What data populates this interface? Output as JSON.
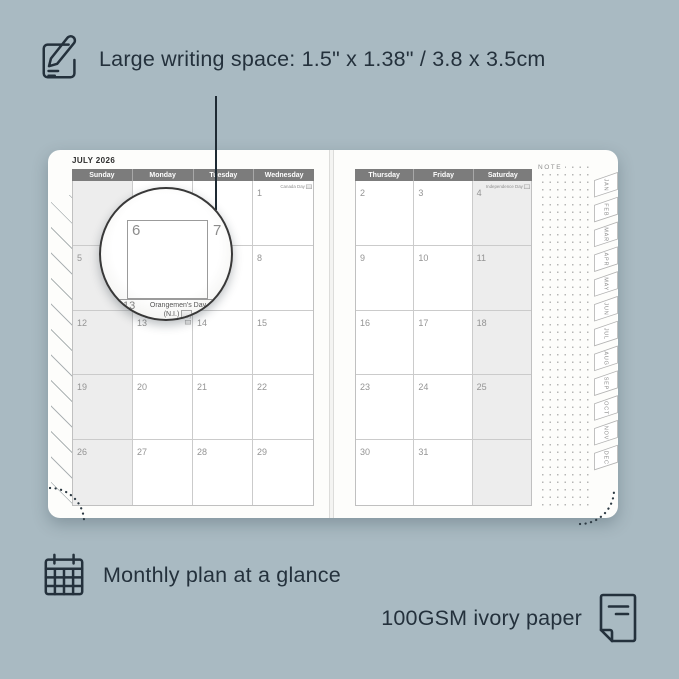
{
  "colors": {
    "background": "#a9bac2",
    "annotation_text": "#24313c",
    "page": "#fdfdfb",
    "header_gray": "#7c7c7c",
    "shaded_column": "#ededed",
    "grid_line": "#cbcbcb",
    "date_text": "#949494"
  },
  "annotations": {
    "top": {
      "icon": "pencil-note-icon",
      "text": "Large writing space: 1.5\" x 1.38\" / 3.8 x 3.5cm"
    },
    "bottom_left": {
      "icon": "calendar-grid-icon",
      "text": "Monthly plan at a glance"
    },
    "bottom_right": {
      "icon": "paper-sheet-icon",
      "text": "100GSM ivory paper"
    }
  },
  "planner": {
    "month_title": "JULY 2026",
    "note_label": "NOTE",
    "left_page": {
      "day_headers": [
        "Sunday",
        "Monday",
        "Tuesday",
        "Wednesday"
      ],
      "shaded_column_index": 0,
      "rows": [
        [
          {
            "date": ""
          },
          {
            "date": ""
          },
          {
            "date": ""
          },
          {
            "date": "1",
            "holiday": "Canada Day",
            "flag": true
          }
        ],
        [
          {
            "date": "5"
          },
          {
            "date": "6"
          },
          {
            "date": "7"
          },
          {
            "date": "8"
          }
        ],
        [
          {
            "date": "12"
          },
          {
            "date": "13",
            "holiday": "Orangemen's Day (N.I.)",
            "flag": true
          },
          {
            "date": "14"
          },
          {
            "date": "15"
          }
        ],
        [
          {
            "date": "19"
          },
          {
            "date": "20"
          },
          {
            "date": "21"
          },
          {
            "date": "22"
          }
        ],
        [
          {
            "date": "26"
          },
          {
            "date": "27"
          },
          {
            "date": "28"
          },
          {
            "date": "29"
          }
        ]
      ]
    },
    "right_page": {
      "day_headers": [
        "Thursday",
        "Friday",
        "Saturday"
      ],
      "shaded_column_index": 2,
      "rows": [
        [
          {
            "date": "2"
          },
          {
            "date": "3"
          },
          {
            "date": "4",
            "holiday": "Independence Day",
            "flag": true
          }
        ],
        [
          {
            "date": "9"
          },
          {
            "date": "10"
          },
          {
            "date": "11"
          }
        ],
        [
          {
            "date": "16"
          },
          {
            "date": "17"
          },
          {
            "date": "18"
          }
        ],
        [
          {
            "date": "23"
          },
          {
            "date": "24"
          },
          {
            "date": "25"
          }
        ],
        [
          {
            "date": "30"
          },
          {
            "date": "31"
          },
          {
            "date": ""
          }
        ]
      ]
    },
    "month_tabs": [
      "JAN",
      "FEB",
      "MAR",
      "APR",
      "MAY",
      "JUN",
      "JUL",
      "AUG",
      "SEP",
      "OCT",
      "NOV",
      "DEC"
    ],
    "magnifier": {
      "left_date": "6",
      "right_date": "7",
      "caption_date": "13",
      "caption_line1": "Orangemen's Day",
      "caption_line2": "(N.I.)"
    }
  }
}
